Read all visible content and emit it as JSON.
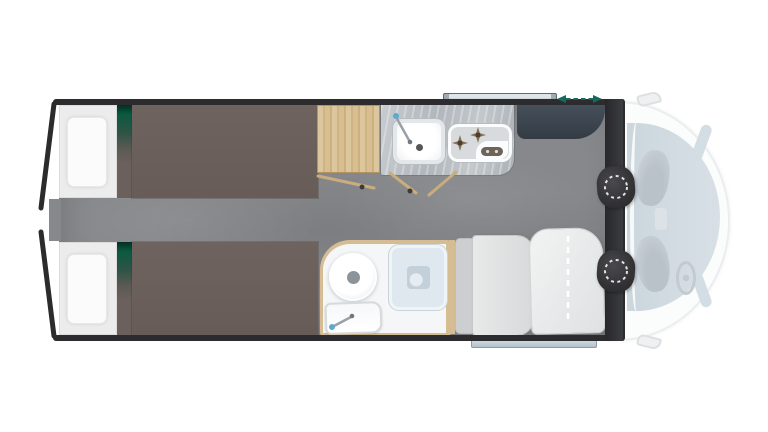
{
  "page": {
    "background": "#ffffff",
    "kind": "motorhome-floorplan",
    "view": "top-down"
  },
  "colors": {
    "wall": "#2c2c2e",
    "floor": "#87888b",
    "mattress": "#6b605b",
    "bed_base": "#ececec",
    "pillow": "#fbfbfb",
    "accent_green": "#0b5a3f",
    "wood": "#d5bc92",
    "wood_line": "#c9ad7c",
    "counter": "#b9bfc4",
    "burner": "#8b7355",
    "hob_pill": "#6e6357",
    "fridge": "#3a434c",
    "seat_dark": "#3a3a3c",
    "cab_body": "#fbfcfc",
    "cab_outline": "#ebedee",
    "windshield": "#cdd8df",
    "ghost": "#c6ced4",
    "bench": "#e2e3e4",
    "backrest": "#cdcecf",
    "table": "#ebecec",
    "shower": "#dfe8ee",
    "shower_drain": "#c3d0da",
    "step_light": "#d3dde4",
    "step_dark": "#b3c1cb",
    "teal": "#15695d",
    "bathroom_floor": "#f4f6f8",
    "faucet_blue": "#5fa9cf",
    "line_grey": "#3a3a3e",
    "window_light": "#dfe6ea",
    "window_dark": "#9aa6af"
  },
  "floorplan": {
    "zones": [
      {
        "id": "rear-bedroom",
        "items": [
          "single-bed-top",
          "single-bed-bottom",
          "pillows",
          "accent-stripes",
          "center-aisle"
        ]
      },
      {
        "id": "midship-kitchen",
        "items": [
          "wardrobe",
          "kitchen-counter",
          "sink-with-faucet",
          "two-burner-hob",
          "refrigerator",
          "door-swing-lines"
        ]
      },
      {
        "id": "washroom",
        "items": [
          "toilet",
          "shower-tray-with-drain",
          "hand-basin-with-faucet",
          "wood-partition"
        ]
      },
      {
        "id": "dinette",
        "items": [
          "bench-seat",
          "folding-table-with-fold-line"
        ]
      },
      {
        "id": "cab",
        "items": [
          "swivel-seat-top",
          "swivel-seat-bottom",
          "ghost-cab-seats",
          "steering-wheel",
          "windshield",
          "side-mirrors",
          "side-windows"
        ]
      },
      {
        "id": "exterior",
        "items": [
          "top-window-strip",
          "sliding-door-arrow",
          "entrance-step",
          "rear-contour-walls"
        ]
      }
    ]
  }
}
